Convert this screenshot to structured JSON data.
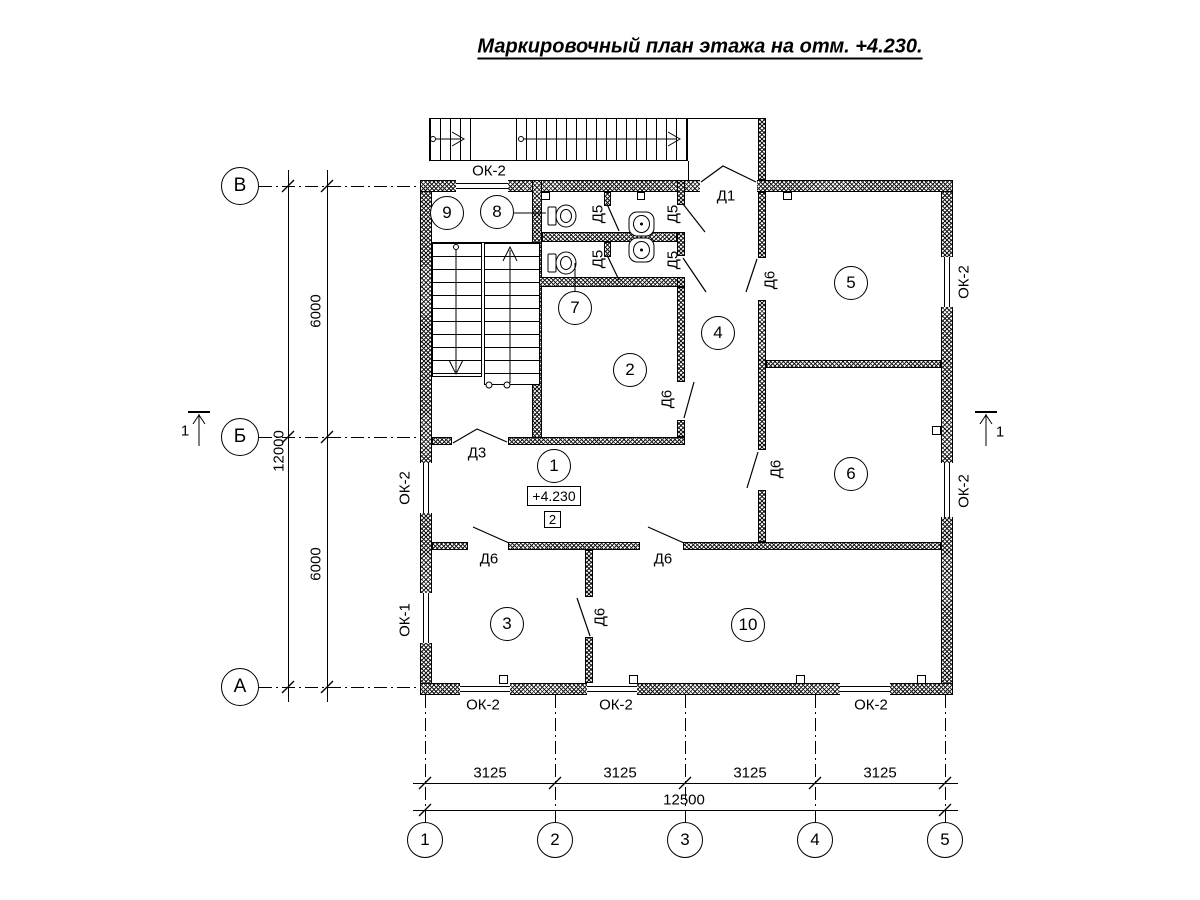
{
  "title": "Маркировочный план этажа на отм. +4.230.",
  "axes": {
    "rows": [
      "В",
      "Б",
      "А"
    ],
    "cols": [
      "1",
      "2",
      "3",
      "4",
      "5"
    ]
  },
  "dimensions": {
    "left": {
      "segments": [
        "6000",
        "6000"
      ],
      "total": "12000"
    },
    "bottom": {
      "segments": [
        "3125",
        "3125",
        "3125",
        "3125"
      ],
      "total": "12500"
    }
  },
  "rooms": [
    "1",
    "2",
    "3",
    "4",
    "5",
    "6",
    "7",
    "8",
    "9",
    "10"
  ],
  "marks": {
    "elevation": "+4.230",
    "zone": "2",
    "section_cut": "1"
  },
  "labels": {
    "d1": "Д1",
    "d3": "Д3",
    "d5": "Д5",
    "d6": "Д6",
    "ok1": "ОК-1",
    "ok2": "ОК-2"
  }
}
